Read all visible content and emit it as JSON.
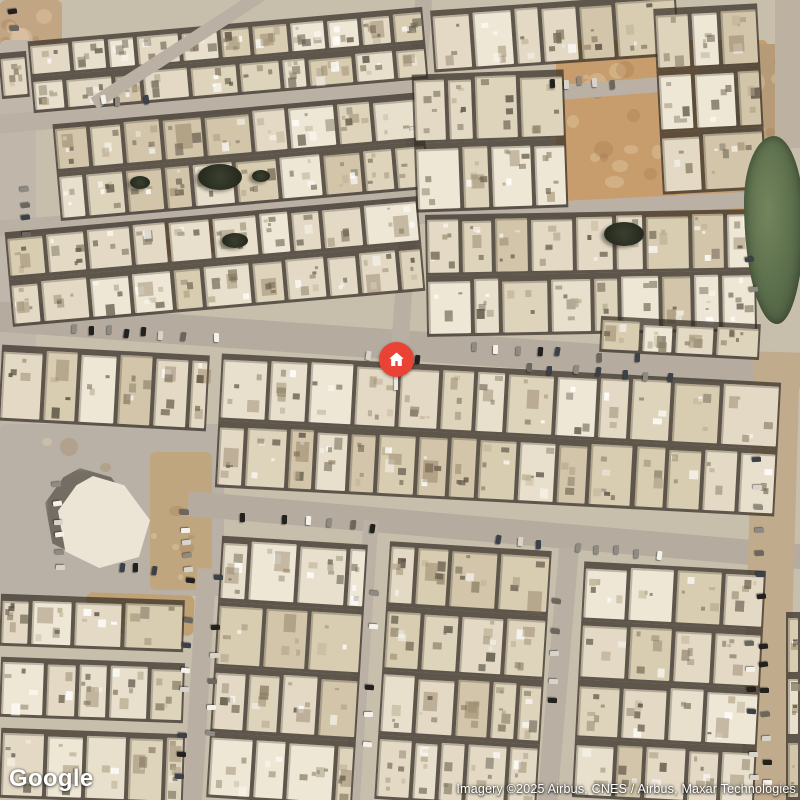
{
  "map": {
    "google_logo": "Google",
    "attribution": "Imagery ©2025 Airbus, CNES / Airbus, Maxar Technologies",
    "marker": {
      "x": 396,
      "y": 359,
      "diameter": 35,
      "color": "#EA4335",
      "icon": "home-icon"
    }
  },
  "palette": {
    "ground": "#c8beac",
    "buildings": [
      "#e8e0cc",
      "#ded3bb",
      "#d8ccb1",
      "#e3d9c4",
      "#efe7d5",
      "#d2c5a9"
    ],
    "roof_specks": [
      "#8d8168",
      "#5a5244",
      "#ffffff",
      "#b5a88c",
      "#6e6553"
    ],
    "cars": [
      "#f4f1ea",
      "#23211e",
      "#8f8b83",
      "#d8d4cb",
      "#3c4149",
      "#6b665e"
    ]
  },
  "scene": {
    "canvas": {
      "w": 800,
      "h": 800
    },
    "patches": [
      {
        "x": 0,
        "y": 0,
        "w": 62,
        "h": 56,
        "c": "#c2a582",
        "m": 8
      },
      {
        "x": 0,
        "y": 40,
        "w": 36,
        "h": 560,
        "c": "#c0b7aa",
        "m": 0
      },
      {
        "x": 0,
        "y": 424,
        "w": 224,
        "h": 172,
        "c": "#b9b1a5",
        "m": 4
      },
      {
        "x": 150,
        "y": 452,
        "w": 62,
        "h": 138,
        "c": "#c0a67f",
        "m": 6
      },
      {
        "x": 556,
        "y": 40,
        "w": 212,
        "h": 178,
        "c": "#c79d6d",
        "m": 26
      },
      {
        "x": 700,
        "y": 44,
        "w": 100,
        "h": 100,
        "c": "#b59b78",
        "m": 10
      },
      {
        "x": 148,
        "y": 214,
        "w": 100,
        "h": 40,
        "c": "#c39c6e",
        "r": -5,
        "m": 6
      },
      {
        "x": 86,
        "y": 594,
        "w": 108,
        "h": 40,
        "c": "#bfa173",
        "r": 2,
        "m": 6
      }
    ],
    "roads": [
      {
        "x1": -10,
        "y1": 316,
        "x2": 810,
        "y2": 374,
        "w": 30,
        "c": "#b5ac9f"
      },
      {
        "x1": 188,
        "y1": 503,
        "x2": 810,
        "y2": 557,
        "w": 25,
        "c": "#b5ac9f"
      },
      {
        "x1": 424,
        "y1": -6,
        "x2": 400,
        "y2": 344,
        "w": 17,
        "c": "#b9b0a3"
      },
      {
        "x1": 207,
        "y1": 568,
        "x2": 192,
        "y2": 806,
        "w": 19,
        "c": "#b9b0a3"
      },
      {
        "x1": 371,
        "y1": 520,
        "x2": 352,
        "y2": 806,
        "w": 15,
        "c": "#bbb2a5"
      },
      {
        "x1": 569,
        "y1": 548,
        "x2": 547,
        "y2": 806,
        "w": 20,
        "c": "#b9b0a3"
      },
      {
        "x1": 777,
        "y1": 352,
        "x2": 764,
        "y2": 806,
        "w": 46,
        "c": "#c0ab8c"
      },
      {
        "x1": 788,
        "y1": -6,
        "x2": 788,
        "y2": 148,
        "w": 26,
        "c": "#bdb2a2"
      },
      {
        "x1": -6,
        "y1": 124,
        "x2": 436,
        "y2": 86,
        "w": 19,
        "c": "#bab1a4"
      },
      {
        "x1": -6,
        "y1": 229,
        "x2": 436,
        "y2": 193,
        "w": 16,
        "c": "#bab1a4"
      },
      {
        "x1": 408,
        "y1": 104,
        "x2": 685,
        "y2": 82,
        "w": 15,
        "c": "#bab1a4"
      },
      {
        "x1": 400,
        "y1": 217,
        "x2": 806,
        "y2": 197,
        "w": 16,
        "c": "#bab1a4"
      },
      {
        "x1": 94,
        "y1": 103,
        "x2": 262,
        "y2": -6,
        "w": 13,
        "c": "#bab1a4",
        "over": true
      }
    ],
    "blocks": [
      {
        "x": 30,
        "y": 24,
        "w": 396,
        "h": 72,
        "r": -5,
        "rows": 2
      },
      {
        "x": 0,
        "y": 52,
        "w": 28,
        "h": 46,
        "r": -5,
        "rows": 1
      },
      {
        "x": 56,
        "y": 108,
        "w": 370,
        "h": 97,
        "r": -5,
        "rows": 2
      },
      {
        "x": 8,
        "y": 214,
        "w": 414,
        "h": 95,
        "r": -5,
        "rows": 2
      },
      {
        "x": 432,
        "y": 2,
        "w": 246,
        "h": 62,
        "r": -4,
        "rows": 1
      },
      {
        "x": 658,
        "y": 6,
        "w": 104,
        "h": 186,
        "r": -3,
        "rows": 3
      },
      {
        "x": 414,
        "y": 72,
        "w": 152,
        "h": 138,
        "r": -2,
        "rows": 2
      },
      {
        "x": 426,
        "y": 212,
        "w": 330,
        "h": 122,
        "r": -1,
        "rows": 2
      },
      {
        "x": 600,
        "y": 320,
        "w": 160,
        "h": 36,
        "r": 3,
        "rows": 1
      },
      {
        "x": 218,
        "y": 368,
        "w": 560,
        "h": 134,
        "r": 3,
        "rows": 2
      },
      {
        "x": 0,
        "y": 350,
        "w": 208,
        "h": 76,
        "r": 3,
        "rows": 1
      },
      {
        "x": 0,
        "y": 597,
        "w": 184,
        "h": 52,
        "r": 2,
        "rows": 1
      },
      {
        "x": 0,
        "y": 660,
        "w": 184,
        "h": 60,
        "r": 2,
        "rows": 1
      },
      {
        "x": 0,
        "y": 731,
        "w": 184,
        "h": 70,
        "r": 2,
        "rows": 1
      },
      {
        "x": 214,
        "y": 540,
        "w": 146,
        "h": 262,
        "r": 3.5,
        "rows": 4
      },
      {
        "x": 382,
        "y": 546,
        "w": 162,
        "h": 258,
        "r": 3.5,
        "rows": 4
      },
      {
        "x": 578,
        "y": 566,
        "w": 182,
        "h": 236,
        "r": 3,
        "rows": 4
      },
      {
        "x": 786,
        "y": 612,
        "w": 14,
        "h": 188,
        "r": 0,
        "rows": 3
      }
    ],
    "landmark": {
      "x": 58,
      "y": 476,
      "w": 92,
      "h": 92
    },
    "pond": {
      "x": 744,
      "y": 136,
      "w": 60,
      "h": 188
    },
    "trees": [
      {
        "x": 198,
        "y": 164,
        "w": 44,
        "h": 26
      },
      {
        "x": 604,
        "y": 222,
        "w": 40,
        "h": 24
      },
      {
        "x": 222,
        "y": 233,
        "w": 26,
        "h": 15
      },
      {
        "x": 130,
        "y": 176,
        "w": 20,
        "h": 13
      },
      {
        "x": 252,
        "y": 170,
        "w": 18,
        "h": 12
      }
    ],
    "car_strips": [
      {
        "x": 30,
        "y": 323,
        "a": 4,
        "n": 11,
        "s": 18,
        "perp": 1
      },
      {
        "x": 470,
        "y": 345,
        "a": 4,
        "n": 9,
        "s": 20,
        "perp": 1
      },
      {
        "x": 520,
        "y": 364,
        "a": 4,
        "n": 8,
        "s": 24,
        "perp": 1
      },
      {
        "x": 360,
        "y": 352,
        "a": 4,
        "n": 5,
        "s": 26,
        "perp": 1
      },
      {
        "x": 235,
        "y": 513,
        "a": 5,
        "n": 7,
        "s": 22,
        "perp": 1
      },
      {
        "x": 492,
        "y": 537,
        "a": 5,
        "n": 9,
        "s": 20,
        "perp": 1
      },
      {
        "x": 752,
        "y": 455,
        "a": 88,
        "n": 15,
        "s": 23,
        "perp": 1
      },
      {
        "x": 744,
        "y": 250,
        "a": 82,
        "n": 3,
        "s": 18,
        "perp": 1
      },
      {
        "x": 186,
        "y": 574,
        "a": 93,
        "n": 10,
        "s": 22,
        "perp": 1
      },
      {
        "x": 214,
        "y": 572,
        "a": 93,
        "n": 8,
        "s": 26,
        "perp": 1
      },
      {
        "x": 372,
        "y": 560,
        "a": 93,
        "n": 7,
        "s": 30,
        "perp": 1
      },
      {
        "x": 552,
        "y": 598,
        "a": 92,
        "n": 5,
        "s": 25,
        "perp": 1
      },
      {
        "x": 20,
        "y": 182,
        "a": 88,
        "n": 4,
        "s": 16,
        "perp": 1
      },
      {
        "x": 8,
        "y": 8,
        "a": 85,
        "n": 3,
        "s": 14,
        "perp": 1
      },
      {
        "x": 95,
        "y": 99,
        "a": -5,
        "n": 4,
        "s": 15,
        "perp": 1
      },
      {
        "x": 545,
        "y": 80,
        "a": 0,
        "n": 5,
        "s": 15,
        "perp": 1
      },
      {
        "x": 180,
        "y": 508,
        "a": 86,
        "n": 5,
        "s": 15,
        "perp": 1
      },
      {
        "x": 52,
        "y": 483,
        "a": 87,
        "n": 6,
        "s": 16,
        "perp": 1
      },
      {
        "x": 112,
        "y": 565,
        "a": 4,
        "n": 3,
        "s": 18,
        "perp": 1
      },
      {
        "x": 745,
        "y": 640,
        "a": 88,
        "n": 7,
        "s": 22,
        "perp": 1
      }
    ]
  }
}
